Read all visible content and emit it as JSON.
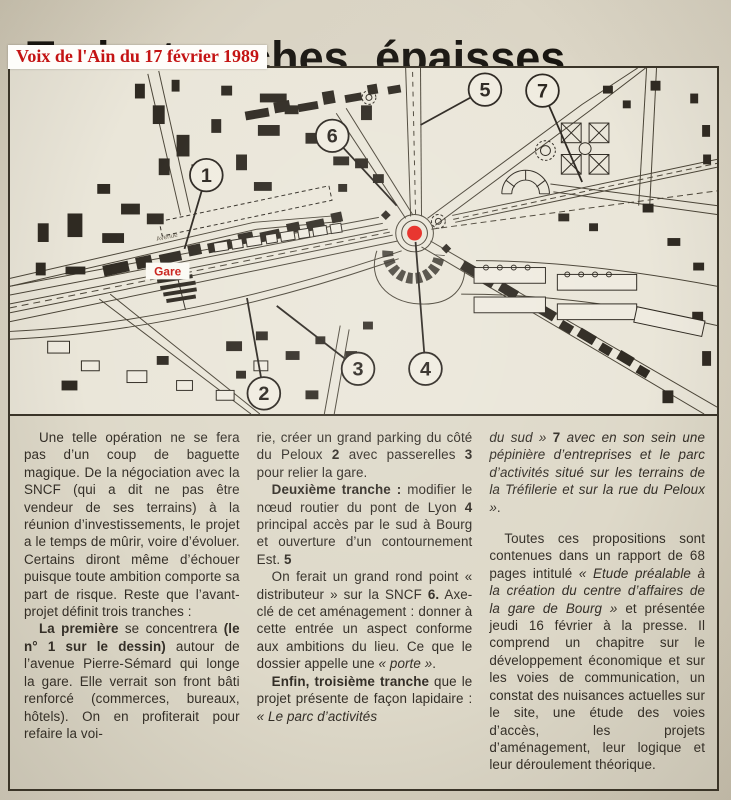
{
  "page": {
    "headline": "Trois tranches épaisses",
    "stamp": "Voix de l'Ain du 17 février 1989",
    "accent_red": "#c41414",
    "ink": "#332e27"
  },
  "map": {
    "gare": {
      "label": "Gare",
      "color": "#c9201a"
    },
    "avenue_label": "Avenue",
    "red_dot": {
      "color": "#e6231c"
    },
    "markers": [
      {
        "n": "1",
        "cx": 198,
        "cy": 109,
        "tx": 176,
        "ty": 184
      },
      {
        "n": "2",
        "cx": 256,
        "cy": 331,
        "tx": 239,
        "ty": 234
      },
      {
        "n": "3",
        "cx": 351,
        "cy": 306,
        "tx": 269,
        "ty": 242
      },
      {
        "n": "4",
        "cx": 419,
        "cy": 306,
        "tx": 409,
        "ty": 177
      },
      {
        "n": "5",
        "cx": 479,
        "cy": 22,
        "tx": 414,
        "ty": 58
      },
      {
        "n": "6",
        "cx": 325,
        "cy": 69,
        "tx": 390,
        "ty": 140
      },
      {
        "n": "7",
        "cx": 537,
        "cy": 23,
        "tx": 577,
        "ty": 116
      }
    ]
  },
  "article": {
    "columns": [
      {
        "paragraphs": [
          {
            "indent": true,
            "runs": [
              {
                "t": "Une telle opération ne se fera pas d’un coup de baguette magique. De la négociation avec la SNCF (qui a dit ne pas être vendeur de ses terrains) à la réunion d’investissements, le projet a le temps de mûrir, voire d’évoluer. Certains diront même d’échouer puisque toute ambition comporte sa part de risque. Reste que l’avant-projet définit trois tranches :"
              }
            ]
          },
          {
            "indent": true,
            "runs": [
              {
                "t": "La première",
                "b": 1
              },
              {
                "t": " se concentrera "
              },
              {
                "t": "(le n° 1 sur le dessin)",
                "b": 1
              },
              {
                "t": " autour de l’avenue Pierre-Sémard qui longe la gare. Elle verrait son front bâti renforcé (commerces, bureaux, hôtels). On en profiterait pour refaire la voi-"
              }
            ]
          }
        ]
      },
      {
        "paragraphs": [
          {
            "indent": false,
            "runs": [
              {
                "t": "rie, créer un grand parking du côté du Peloux  "
              },
              {
                "t": "2",
                "b": 1
              },
              {
                "t": "  avec passerelles "
              },
              {
                "t": "3",
                "b": 1
              },
              {
                "t": "  pour relier la gare."
              }
            ]
          },
          {
            "indent": true,
            "runs": [
              {
                "t": "Deuxième tranche :",
                "b": 1
              },
              {
                "t": " modifier le nœud routier du pont de Lyon "
              },
              {
                "t": "4",
                "b": 1
              },
              {
                "t": "  principal accès par le sud à Bourg et ouverture d’un contournement Est. "
              },
              {
                "t": "5",
                "b": 1
              }
            ]
          },
          {
            "indent": true,
            "runs": [
              {
                "t": "On ferait un grand rond point « distributeur » sur la SNCF "
              },
              {
                "t": "6.",
                "b": 1
              },
              {
                "t": "  Axe-clé de cet aménagement : donner à cette entrée un aspect conforme aux ambitions du lieu. Ce que le dossier appelle une "
              },
              {
                "t": "« porte »",
                "i": 1
              },
              {
                "t": "."
              }
            ]
          },
          {
            "indent": true,
            "runs": [
              {
                "t": "Enfin, troisième tranche",
                "b": 1
              },
              {
                "t": " que le projet présente de façon lapidaire : "
              },
              {
                "t": "« Le parc d’activités",
                "i": 1
              }
            ]
          }
        ]
      },
      {
        "paragraphs": [
          {
            "indent": false,
            "runs": [
              {
                "t": "du sud »",
                "i": 1
              },
              {
                "t": " "
              },
              {
                "t": "7",
                "b": 1
              },
              {
                "t": "  "
              },
              {
                "t": "avec en son sein une pépinière d’entreprises et le parc d’activités situé sur les terrains de la Tréfilerie et sur la rue du Peloux »",
                "i": 1
              },
              {
                "t": "."
              }
            ]
          },
          {
            "indent": true,
            "gap": true,
            "runs": [
              {
                "t": "Toutes ces propositions sont contenues dans un rapport de 68 pages intitulé "
              },
              {
                "t": "« Etude préalable à la création du centre d’affaires de la gare de Bourg »",
                "i": 1
              },
              {
                "t": " et présentée jeudi 16 février à la presse. Il comprend un chapitre sur le développement économique et sur les voies de communication, un constat des nuisances actuelles sur le site, une étude des voies d’accès, les projets d’aménagement, leur logique et leur déroulement théorique."
              }
            ]
          }
        ]
      }
    ]
  }
}
